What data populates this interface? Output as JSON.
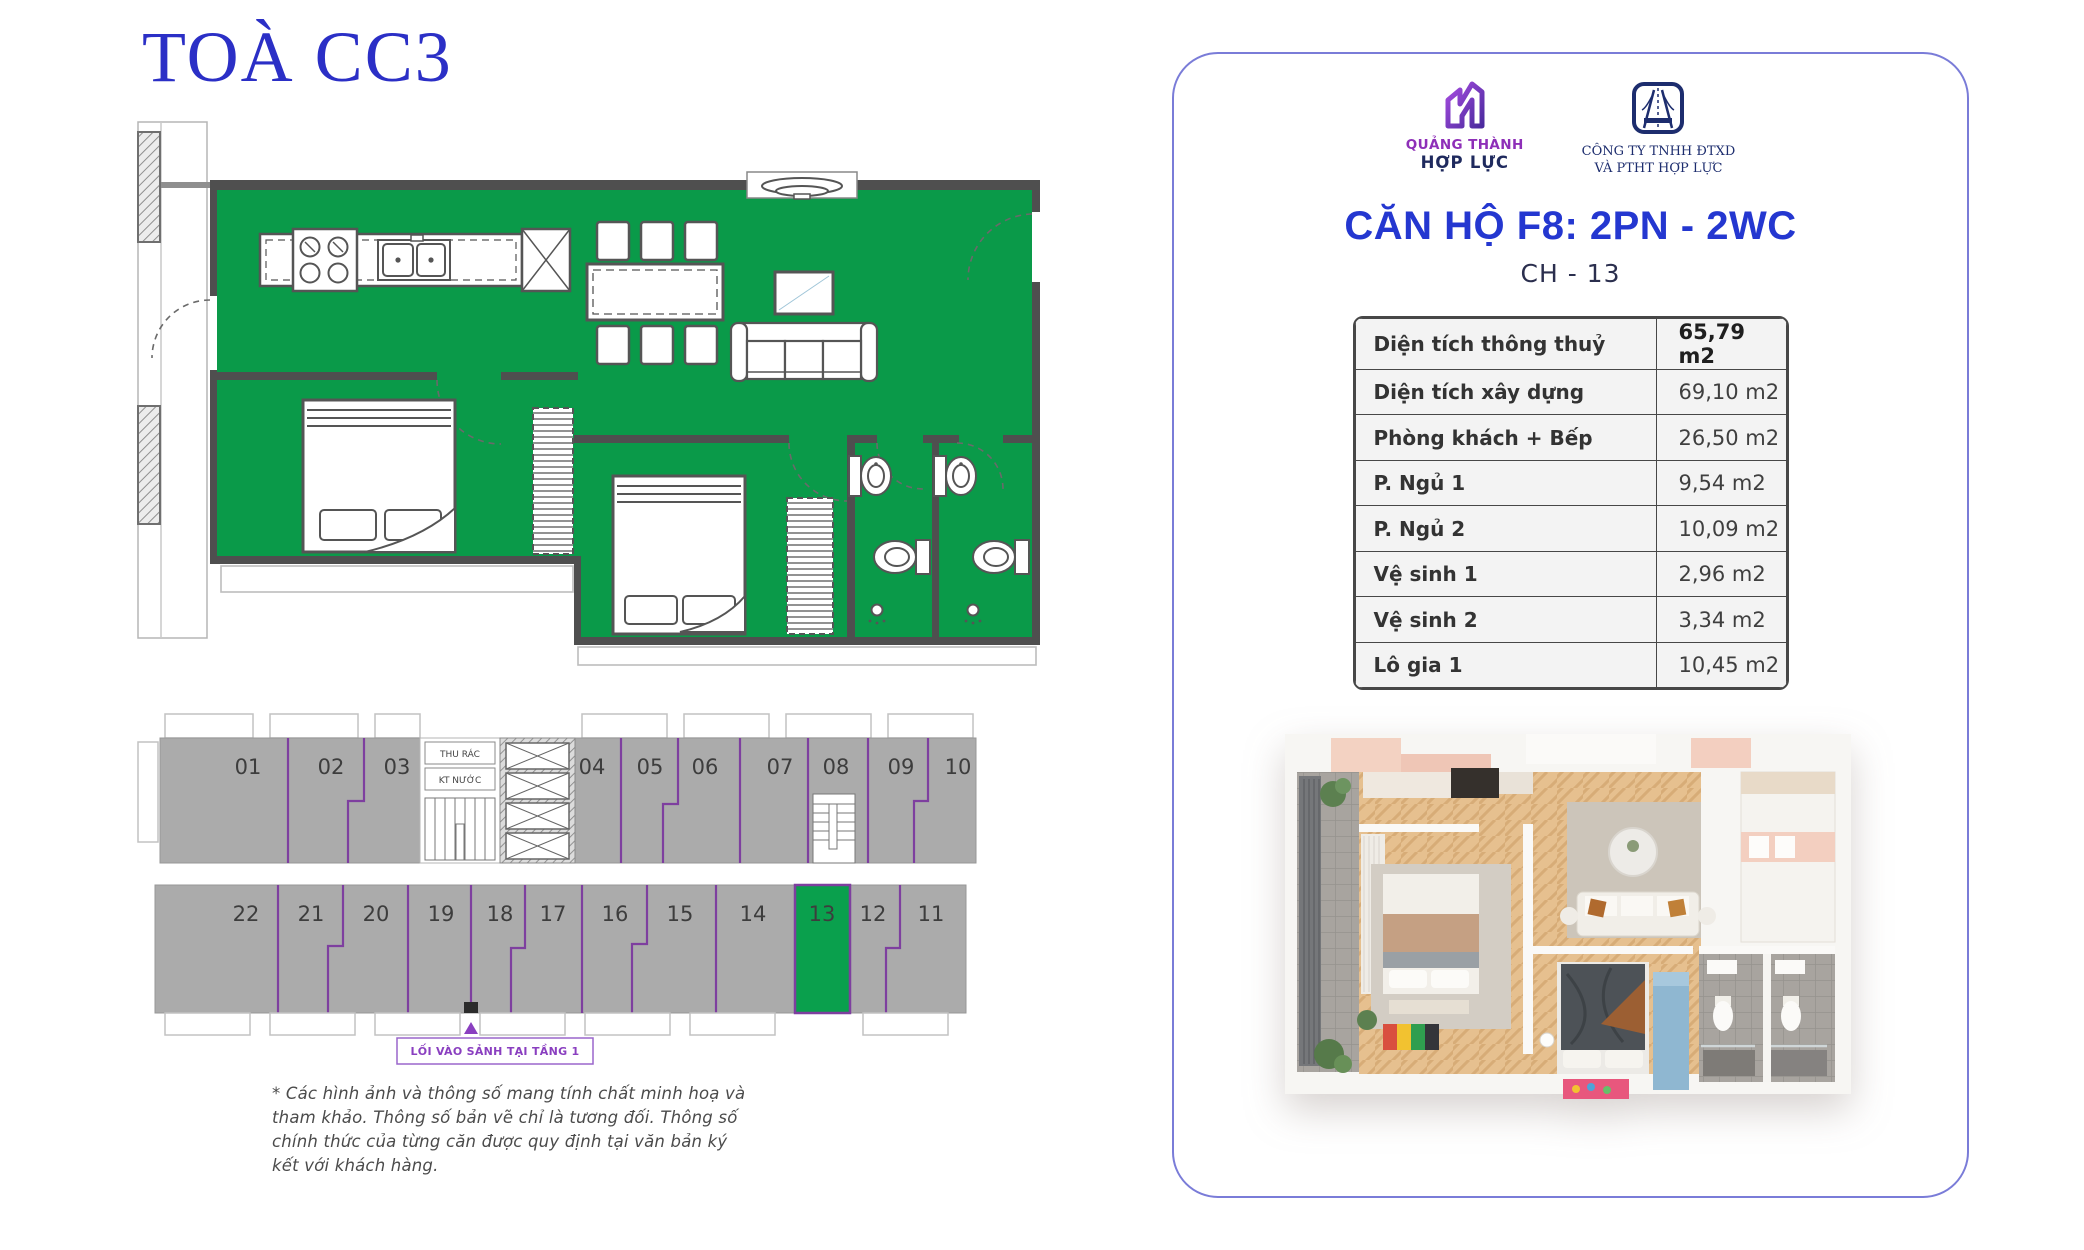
{
  "page": {
    "building_title": "TOÀ CC3",
    "disclaimer": "* Các hình ảnh và thông số mang tính chất minh hoạ và tham khảo. Thông số bản vẽ chỉ là tương đối. Thông số chính thức của từng căn được quy định tại văn bản ký kết với khách hàng."
  },
  "card": {
    "logo1": {
      "line1": "QUẢNG THÀNH",
      "line2": "HỢP LỰC"
    },
    "logo2": {
      "line1": "CÔNG TY TNHH ĐTXD",
      "line2": "VÀ PTHT HỢP LỰC"
    },
    "title": "CĂN HỘ F8: 2PN - 2WC",
    "subtitle": "CH - 13",
    "area_table": {
      "rows": [
        {
          "label": "Diện tích thông thuỷ",
          "value": "65,79 m2"
        },
        {
          "label": "Diện tích xây dựng",
          "value": "69,10 m2"
        },
        {
          "label": "Phòng khách + Bếp",
          "value": "26,50 m2"
        },
        {
          "label": "P. Ngủ 1",
          "value": "9,54 m2"
        },
        {
          "label": "P. Ngủ 2",
          "value": "10,09 m2"
        },
        {
          "label": "Vệ sinh 1",
          "value": "2,96 m2"
        },
        {
          "label": "Vệ sinh 2",
          "value": "3,34 m2"
        },
        {
          "label": "Lô gia 1",
          "value": "10,45 m2"
        }
      ]
    }
  },
  "floorplate": {
    "top_units": [
      "01",
      "02",
      "03",
      "04",
      "05",
      "06",
      "07",
      "08",
      "09",
      "10"
    ],
    "bottom_units": [
      "22",
      "21",
      "20",
      "19",
      "18",
      "17",
      "16",
      "15",
      "14",
      "13",
      "12",
      "11"
    ],
    "highlighted_unit": "13",
    "core_labels": {
      "trash": "THU RÁC",
      "water": "KT NƯỚC"
    },
    "entrance_label": "LỐI VÀO SẢNH TẠI TẦNG 1"
  },
  "colors": {
    "title_blue": "#2b2fc6",
    "brand_blue": "#2437d0",
    "plan_green": "#0a9a49",
    "unit_green": "#0aa04d",
    "divider_purple": "#7e3f9f",
    "entrance_purple": "#8a3fc0",
    "logo_purple": "#8e2fb8",
    "logo_navy": "#1d2d6e",
    "block_grey": "#ababab",
    "card_border": "#7a7cd8"
  }
}
